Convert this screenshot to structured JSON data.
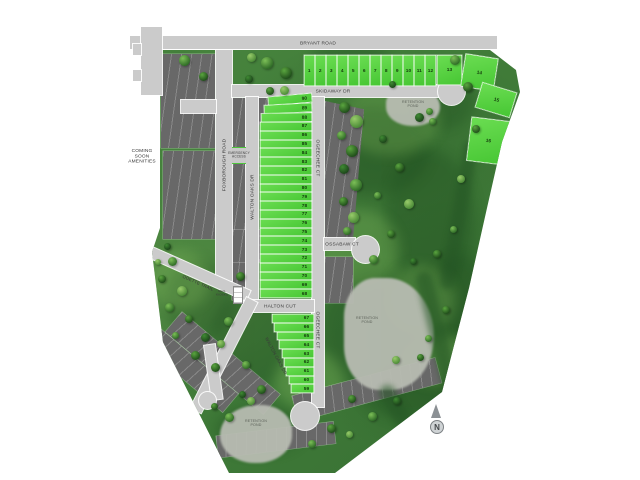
{
  "site_plan": {
    "roads": {
      "bryant": "BRYANT ROAD",
      "skidaway": "SKIDAWAY DR",
      "foxborough": "FOXBOROUGH ROAD",
      "walton_oaks_upper": "WALTON OAKS DR",
      "walton_oaks_lower": "WALTON OAKS DR",
      "ogeechee_upper": "OGEECHEE CT",
      "ogeechee_lower": "OGEECHEE CT",
      "ossabaw": "OSSABAW CT",
      "halton": "HALTON CUT",
      "odette": "ODETTE TRAIL"
    },
    "labels": {
      "coming_soon": [
        "COMING",
        "SOON",
        "AMENITIES"
      ],
      "emergency_access": [
        "EMERGENCY",
        "ACCESS"
      ],
      "retention_pond": [
        "RETENTION",
        "POND"
      ],
      "mail_kiosks": [
        "MAIL",
        "KIOSKS"
      ],
      "compass_north": "N"
    },
    "lots": {
      "bryant_row": [
        "1",
        "2",
        "3",
        "4",
        "5",
        "6",
        "7",
        "8",
        "9",
        "10",
        "11",
        "12"
      ],
      "skidaway_cluster": [
        "13",
        "14",
        "15",
        "16"
      ],
      "central_column": [
        "90",
        "89",
        "88",
        "87",
        "86",
        "85",
        "84",
        "83",
        "82",
        "81",
        "80",
        "79",
        "78",
        "77",
        "76",
        "75",
        "74",
        "73",
        "72",
        "71",
        "70",
        "69",
        "68"
      ],
      "south_column": [
        "67",
        "66",
        "65",
        "64",
        "63",
        "62",
        "61",
        "60",
        "59"
      ]
    },
    "colors": {
      "available_lot": "#5cd63f",
      "future_lot": "#686868",
      "road": "#cbcbcb",
      "grass": "#44793b",
      "pond": "#b8bcb2"
    }
  }
}
